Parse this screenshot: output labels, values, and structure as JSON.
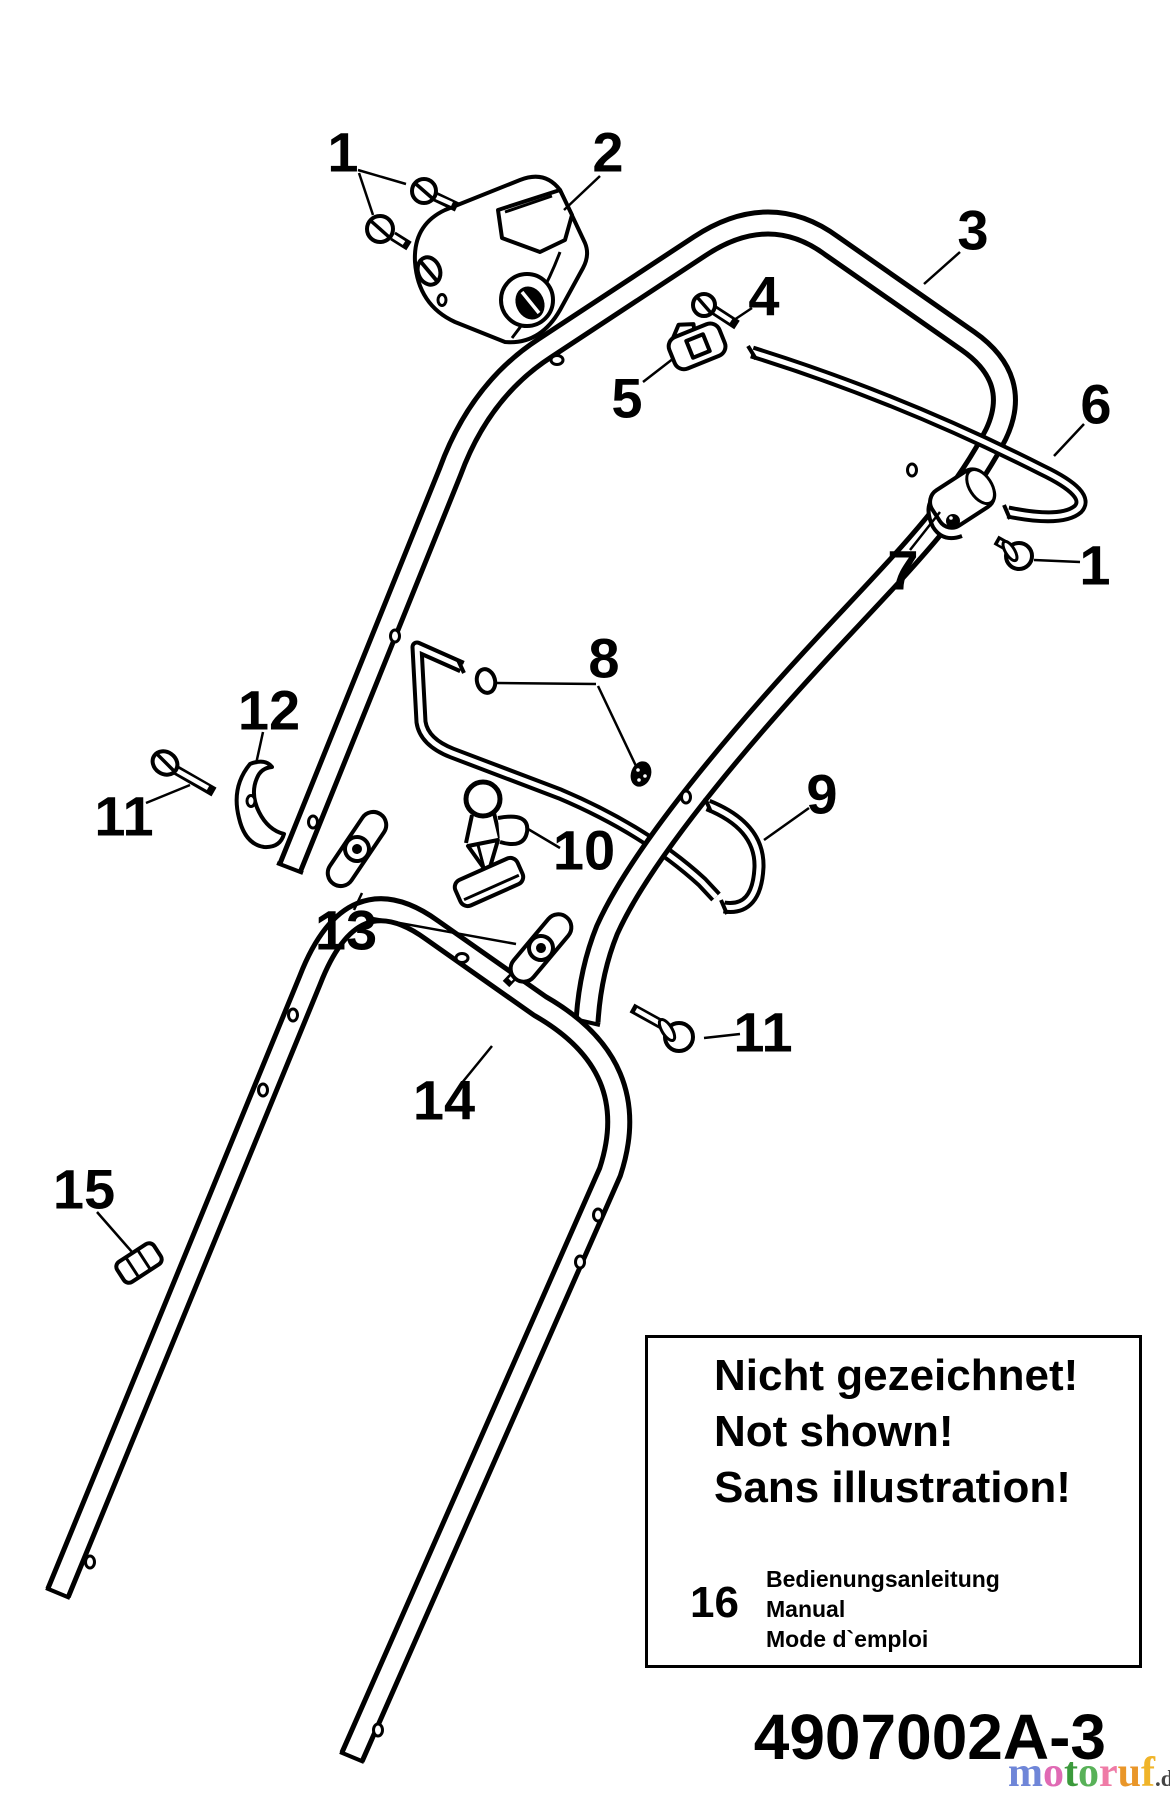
{
  "diagram": {
    "title_part_number": "4907002A-3",
    "callouts": [
      {
        "label": "1",
        "x": 343,
        "y": 152,
        "leaders": [
          [
            358,
            170,
            406,
            184
          ],
          [
            359,
            173,
            373,
            215
          ]
        ]
      },
      {
        "label": "2",
        "x": 608,
        "y": 152,
        "leaders": [
          [
            600,
            176,
            564,
            210
          ]
        ]
      },
      {
        "label": "3",
        "x": 973,
        "y": 230,
        "leaders": [
          [
            960,
            252,
            924,
            284
          ]
        ]
      },
      {
        "label": "4",
        "x": 764,
        "y": 296,
        "leaders": [
          [
            752,
            308,
            734,
            320
          ]
        ]
      },
      {
        "label": "5",
        "x": 627,
        "y": 398,
        "leaders": [
          [
            643,
            382,
            674,
            358
          ]
        ]
      },
      {
        "label": "6",
        "x": 1096,
        "y": 404,
        "leaders": [
          [
            1084,
            424,
            1054,
            456
          ]
        ]
      },
      {
        "label": "7",
        "x": 903,
        "y": 570,
        "leaders": [
          [
            910,
            550,
            940,
            512
          ]
        ]
      },
      {
        "label": "1",
        "x": 1095,
        "y": 565,
        "leaders": [
          [
            1080,
            562,
            1034,
            560
          ]
        ]
      },
      {
        "label": "8",
        "x": 604,
        "y": 658,
        "leaders": [
          [
            497,
            683,
            596,
            684
          ],
          [
            598,
            686,
            636,
            766
          ]
        ]
      },
      {
        "label": "9",
        "x": 822,
        "y": 794,
        "leaders": [
          [
            809,
            808,
            764,
            840
          ]
        ]
      },
      {
        "label": "10",
        "x": 584,
        "y": 850,
        "leaders": [
          [
            560,
            848,
            528,
            829
          ]
        ]
      },
      {
        "label": "11",
        "x": 124,
        "y": 816,
        "leaders": [
          [
            146,
            803,
            190,
            785
          ]
        ]
      },
      {
        "label": "12",
        "x": 269,
        "y": 710,
        "leaders": [
          [
            263,
            732,
            256,
            764
          ]
        ]
      },
      {
        "label": "13",
        "x": 346,
        "y": 930,
        "leaders": [
          [
            354,
            910,
            362,
            893
          ],
          [
            372,
            918,
            516,
            944
          ]
        ]
      },
      {
        "label": "14",
        "x": 444,
        "y": 1100,
        "leaders": [
          [
            461,
            1084,
            492,
            1046
          ]
        ]
      },
      {
        "label": "11",
        "x": 763,
        "y": 1032,
        "leaders": [
          [
            740,
            1034,
            704,
            1038
          ]
        ]
      },
      {
        "label": "15",
        "x": 84,
        "y": 1189,
        "leaders": [
          [
            97,
            1212,
            132,
            1252
          ]
        ]
      }
    ],
    "notes_box": {
      "lines": [
        "Nicht gezeichnet!",
        "Not shown!",
        "Sans illustration!"
      ],
      "item_number": "16",
      "item_lines": [
        "Bedienungsanleitung",
        "Manual",
        "Mode d`emploi"
      ]
    },
    "part_number": "4907002A-3",
    "logo": {
      "letters": [
        {
          "ch": "m",
          "color": "#6f86d8"
        },
        {
          "ch": "o",
          "color": "#e06ab4"
        },
        {
          "ch": "t",
          "color": "#3c9a3c"
        },
        {
          "ch": "o",
          "color": "#58b158"
        },
        {
          "ch": "r",
          "color": "#ef7ba6"
        },
        {
          "ch": "u",
          "color": "#e99629"
        },
        {
          "ch": "f",
          "color": "#f0b429"
        }
      ],
      "suffix": ".de"
    }
  }
}
